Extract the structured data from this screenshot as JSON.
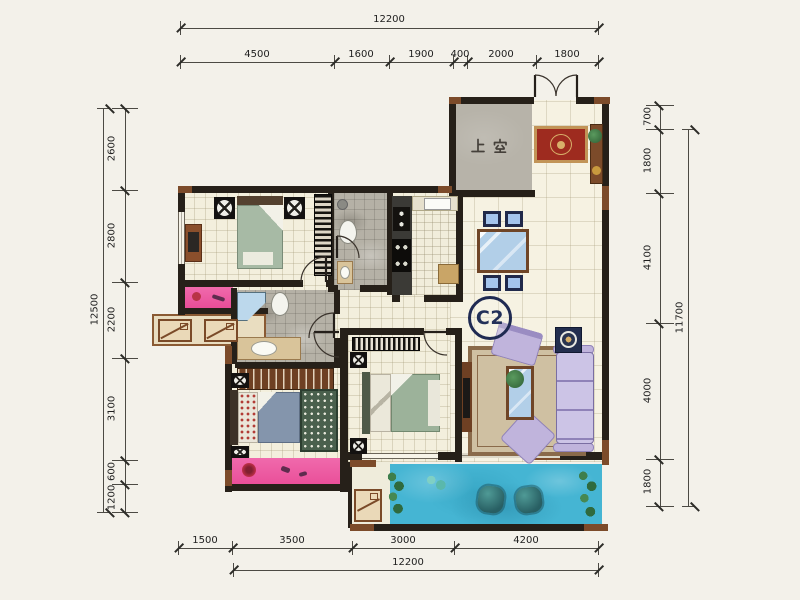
{
  "labels": {
    "unit": "C2",
    "void": "上空"
  },
  "dimensions": {
    "top": {
      "total": "12200",
      "segments": [
        "4500",
        "1600",
        "1900",
        "400",
        "2000",
        "1800"
      ]
    },
    "left": {
      "total": "12500",
      "segments": [
        "2600",
        "2800",
        "2200",
        "3100",
        "600",
        "1200"
      ]
    },
    "right": {
      "total": "11700",
      "segments": [
        "700",
        "1800",
        "4100",
        "4000",
        "1800"
      ]
    },
    "bottom": {
      "total": "12200",
      "segments": [
        "1500",
        "3500",
        "3000",
        "4200"
      ]
    }
  },
  "colors": {
    "wall": "#262019",
    "wood": "#7c4b2a",
    "pool": "#45b5d3",
    "balcony_pink": "#ee58a0",
    "sofa": "#c0b4dc",
    "void_gray": "#b7b3a9",
    "bed_green": "#a7baa5",
    "bed_blue": "#8495ac",
    "entry_rug": "#9e2b1f"
  }
}
